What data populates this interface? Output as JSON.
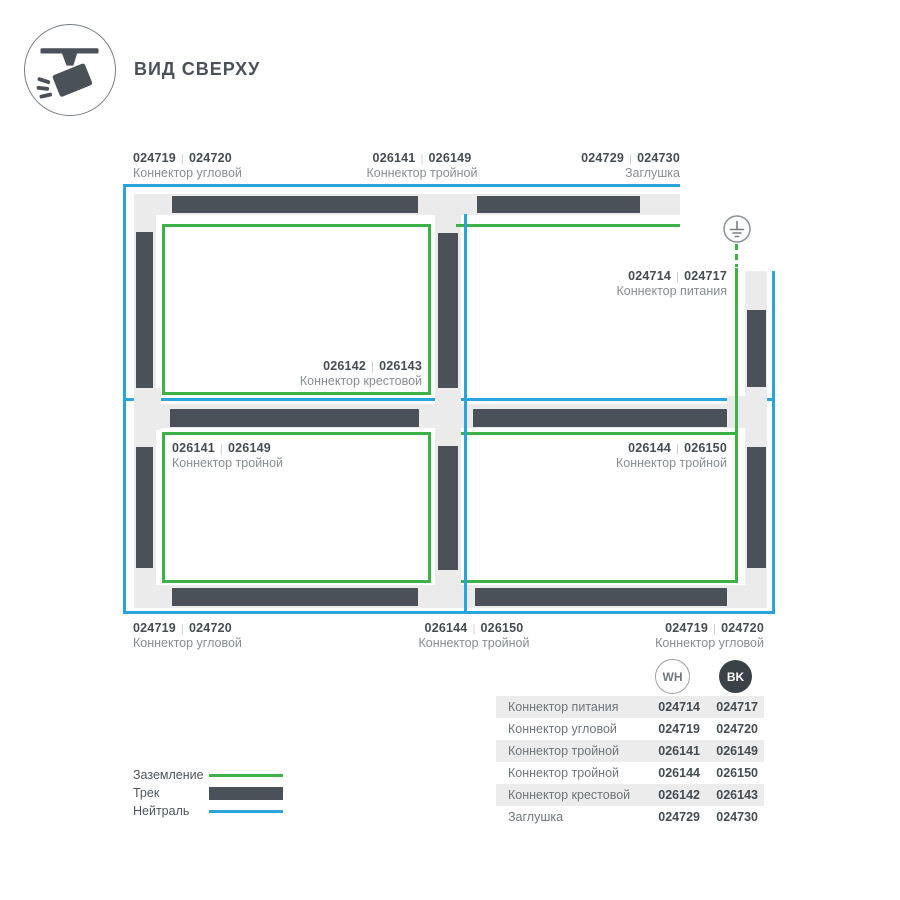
{
  "ui": {
    "sep": "|"
  },
  "header": {
    "title": "ВИД СВЕРХУ",
    "icon": "track-spotlight-icon"
  },
  "diagram": {
    "ground_symbol": "earth-ground-icon",
    "labels": {
      "top_left": {
        "code_wh": "024719",
        "code_bk": "024720",
        "name": "Коннектор угловой"
      },
      "top_center": {
        "code_wh": "026141",
        "code_bk": "026149",
        "name": "Коннектор тройной"
      },
      "top_right": {
        "code_wh": "024729",
        "code_bk": "024730",
        "name": "Заглушка"
      },
      "power": {
        "code_wh": "024714",
        "code_bk": "024717",
        "name": "Коннектор питания"
      },
      "cross": {
        "code_wh": "026142",
        "code_bk": "026143",
        "name": "Коннектор крестовой"
      },
      "mid_left": {
        "code_wh": "026141",
        "code_bk": "026149",
        "name": "Коннектор тройной"
      },
      "mid_right": {
        "code_wh": "026144",
        "code_bk": "026150",
        "name": "Коннектор тройной"
      },
      "bottom_left": {
        "code_wh": "024719",
        "code_bk": "024720",
        "name": "Коннектор угловой"
      },
      "bottom_center": {
        "code_wh": "026144",
        "code_bk": "026150",
        "name": "Коннектор тройной"
      },
      "bottom_right": {
        "code_wh": "024719",
        "code_bk": "024720",
        "name": "Коннектор угловой"
      }
    }
  },
  "legend": {
    "items": [
      {
        "label": "Заземление",
        "swatch": "ground-line"
      },
      {
        "label": "Трек",
        "swatch": "track-bar"
      },
      {
        "label": "Нейтраль",
        "swatch": "neutral-line"
      }
    ]
  },
  "table": {
    "col_wh": "WH",
    "col_bk": "BK",
    "rows": [
      {
        "name": "Коннектор питания",
        "wh": "024714",
        "bk": "024717"
      },
      {
        "name": "Коннектор угловой",
        "wh": "024719",
        "bk": "024720"
      },
      {
        "name": "Коннектор тройной",
        "wh": "026141",
        "bk": "026149"
      },
      {
        "name": "Коннектор тройной",
        "wh": "026144",
        "bk": "026150"
      },
      {
        "name": "Коннектор крестовой",
        "wh": "026142",
        "bk": "026143"
      },
      {
        "name": "Заглушка",
        "wh": "024729",
        "bk": "024730"
      }
    ]
  },
  "colors": {
    "track": "#4a5158",
    "track_bg": "#ebebeb",
    "neutral": "#2aa4dc",
    "ground": "#3eb149"
  }
}
